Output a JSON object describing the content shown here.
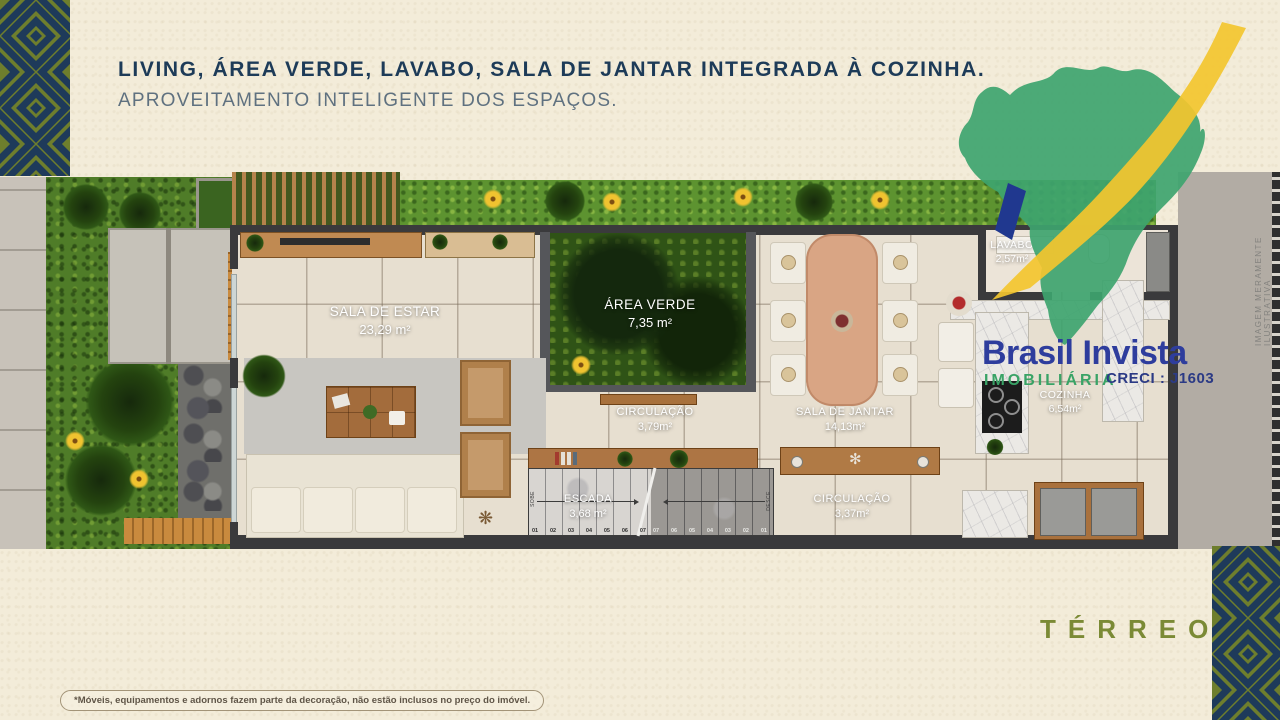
{
  "header": {
    "title": "LIVING, ÁREA VERDE, LAVABO, SALA DE JANTAR INTEGRADA À COZINHA.",
    "subtitle": "APROVEITAMENTO INTELIGENTE DOS ESPAÇOS."
  },
  "logo": {
    "brand": "Brasil Invista",
    "tagline": "IMOBILIÁRIA",
    "creci": "CRECI : J1603",
    "map_green": "#3ea46f",
    "swoosh_yellow": "#f3c52f",
    "sliver_navy": "#20388f",
    "brand_blue": "#2e3d9d",
    "tagline_green": "#39a366"
  },
  "plan": {
    "floor_label": "TÉRREO",
    "watermark": "IMAGEM MERAMENTE ILUSTRATIVA",
    "disclaimer": "*Móveis, equipamentos e adornos fazem parte da decoração, não estão inclusos no preço do imóvel.",
    "rooms": [
      {
        "name": "SALA DE ESTAR",
        "area": "23,29 m²"
      },
      {
        "name": "ÁREA VERDE",
        "area": "7,35 m²"
      },
      {
        "name": "CIRCULAÇÃO",
        "area": "3,79m²"
      },
      {
        "name": "SALA DE JANTAR",
        "area": "14,13m²"
      },
      {
        "name": "ESCADA",
        "area": "3,68 m²"
      },
      {
        "name": "CIRCULAÇÃO",
        "area": "3,37m²"
      },
      {
        "name": "LAVABO",
        "area": "2,57m²"
      },
      {
        "name": "COZINHA",
        "area": "6,54m²"
      }
    ],
    "stairs": {
      "label_up": "SOBE",
      "label_down": "DESCE",
      "steps_up": [
        "01",
        "02",
        "03",
        "04",
        "05",
        "06",
        "07"
      ],
      "steps_down": [
        "07",
        "06",
        "05",
        "04",
        "03",
        "02",
        "01"
      ]
    }
  },
  "theme": {
    "background_cream": "#f3ecd9",
    "pattern_olive": "#6e7e2d",
    "pattern_navy": "#1e3a5a",
    "title_navy": "#1d3b58",
    "subtitle_gray": "#5f7180",
    "terreo_olive": "#7b8a35"
  }
}
